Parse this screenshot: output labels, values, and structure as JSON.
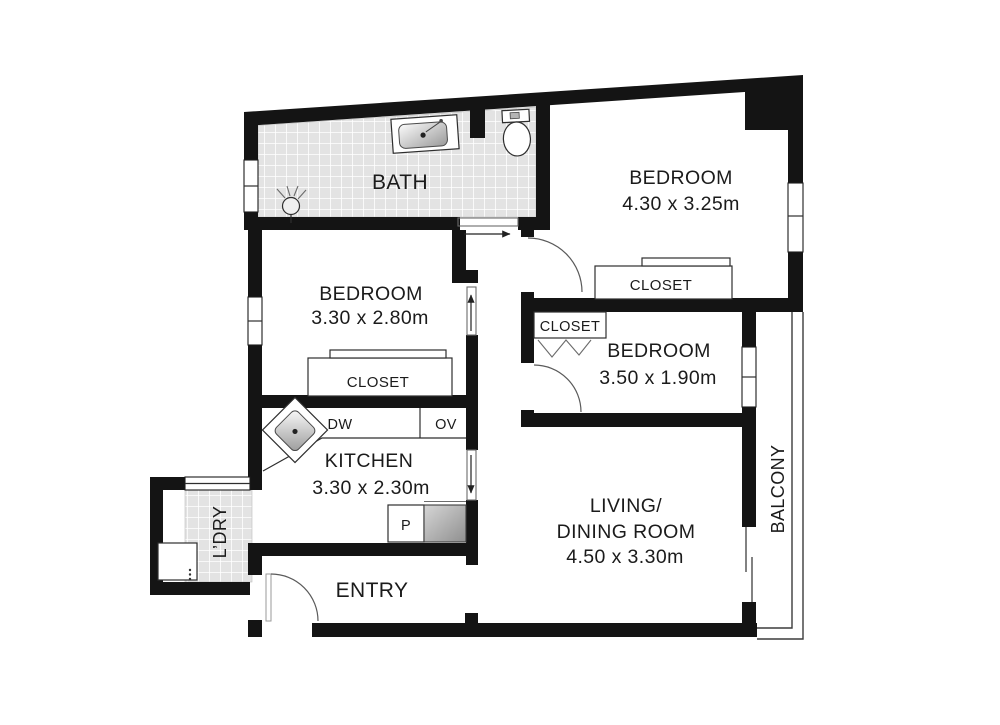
{
  "colors": {
    "wall": "#141414",
    "tile_fill": "#e3e3e3",
    "tile_grout": "#ffffff",
    "text": "#1b1b1b",
    "door_arc": "#5a5a5a",
    "appliance_gray": "#9a9a9a",
    "background": "#ffffff"
  },
  "plan": {
    "bath": {
      "name": "BATH"
    },
    "bedroom_top": {
      "name": "BEDROOM",
      "dims": "4.30 x 3.25m"
    },
    "closet_top": {
      "name": "CLOSET"
    },
    "bedroom_left": {
      "name": "BEDROOM",
      "dims": "3.30 x 2.80m"
    },
    "closet_left": {
      "name": "CLOSET"
    },
    "bedroom_small": {
      "name": "BEDROOM",
      "dims": "3.50 x 1.90m"
    },
    "closet_small": {
      "name": "CLOSET"
    },
    "kitchen": {
      "name": "KITCHEN",
      "dims": "3.30 x 2.30m",
      "dishwasher": "DW",
      "oven": "OV",
      "pantry": "P"
    },
    "living_dining": {
      "line1": "LIVING/",
      "line2": "DINING ROOM",
      "dims": "4.50 x 3.30m"
    },
    "entry": {
      "name": "ENTRY"
    },
    "laundry": {
      "name": "L’DRY"
    },
    "balcony": {
      "name": "BALCONY"
    }
  }
}
